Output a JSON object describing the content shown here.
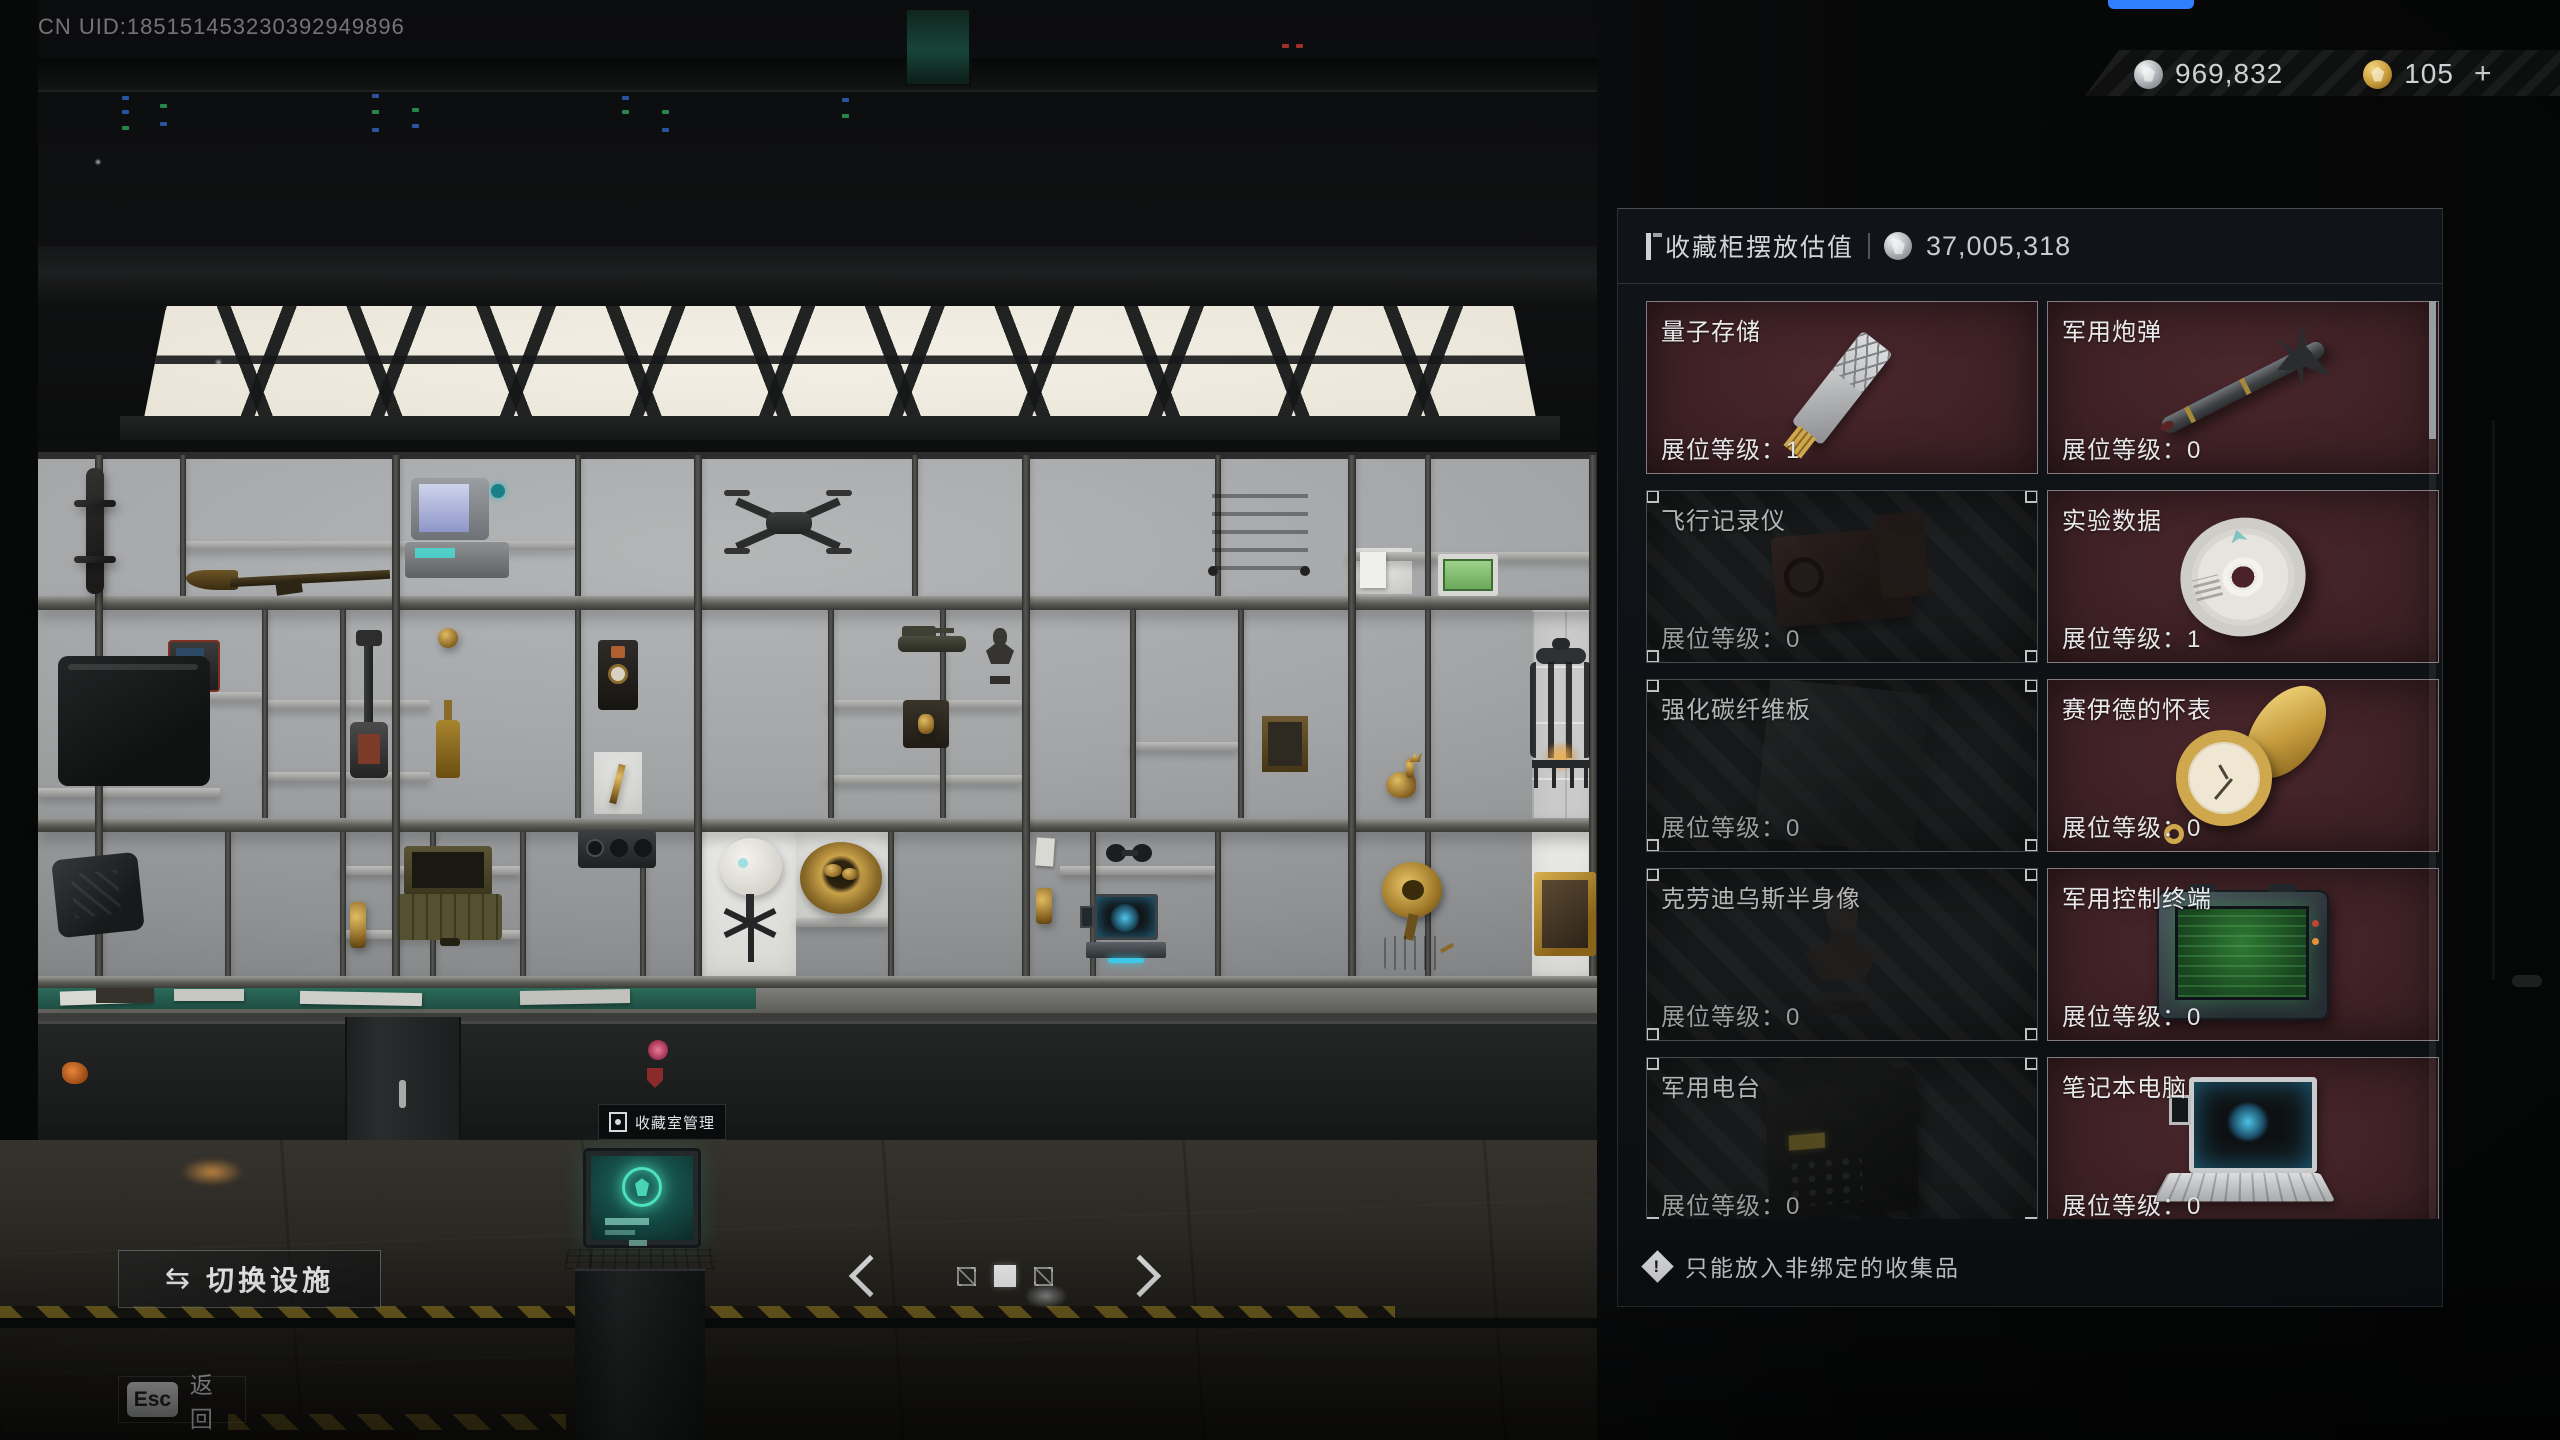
{
  "colors": {
    "card_owned_bg": "#3a1f23",
    "card_empty_bg": "#17191a",
    "panel_bg": "#12161a",
    "silver_coin": "#c9ced2",
    "gold_coin": "#d4a94e",
    "terminal_screen_green": "#2f7a33",
    "holo_cyan": "#4fc4e8",
    "kiosk_screen_teal": "#1d5f58",
    "blue_pill": "#2f7fff"
  },
  "hud": {
    "uid": "CN UID:185151453230392949896",
    "currency_silver": "969,832",
    "currency_gold": "105",
    "currency_add": "+"
  },
  "panel": {
    "title": "收藏柜摆放估值",
    "total_value": "37,005,318",
    "slot_level_label": "展位等级：",
    "note": "只能放入非绑定的收集品",
    "items": [
      {
        "name": "量子存储",
        "level": "1",
        "state": "owned",
        "art": "usb"
      },
      {
        "name": "军用炮弹",
        "level": "0",
        "state": "owned",
        "art": "missile"
      },
      {
        "name": "飞行记录仪",
        "level": "0",
        "state": "empty",
        "art": "flightrec"
      },
      {
        "name": "实验数据",
        "level": "1",
        "state": "owned",
        "art": "cd"
      },
      {
        "name": "强化碳纤维板",
        "level": "0",
        "state": "empty",
        "art": "plate"
      },
      {
        "name": "赛伊德的怀表",
        "level": "0",
        "state": "owned",
        "art": "watch"
      },
      {
        "name": "克劳迪乌斯半身像",
        "level": "0",
        "state": "empty",
        "art": "bust"
      },
      {
        "name": "军用控制终端",
        "level": "0",
        "state": "owned",
        "art": "terminal"
      },
      {
        "name": "军用电台",
        "level": "0",
        "state": "empty",
        "art": "radio"
      },
      {
        "name": "笔记本电脑",
        "level": "0",
        "state": "owned",
        "art": "laptop"
      }
    ]
  },
  "scene": {
    "kiosk_label": "收藏室管理"
  },
  "footer": {
    "switch_facility": "切换设施",
    "esc_key": "Esc",
    "back_label": "返回"
  }
}
